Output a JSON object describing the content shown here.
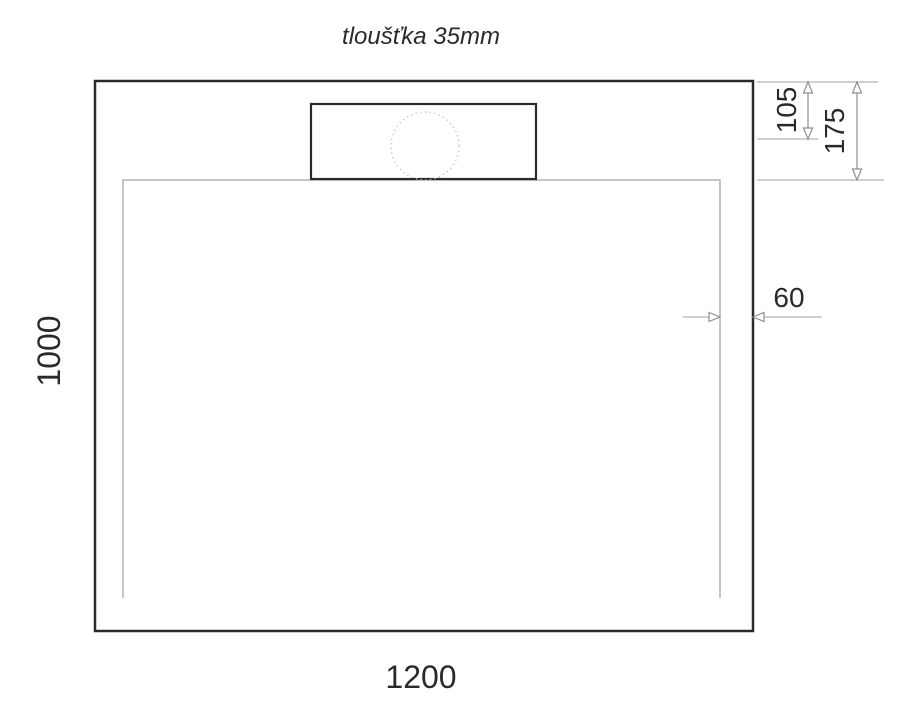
{
  "drawing": {
    "title": "tloušťka 35mm",
    "labels": {
      "bottom_width": "1200",
      "left_height": "1000",
      "right_rim_offset": "60",
      "drain_center_from_top": "105",
      "inner_edge_from_top": "175"
    },
    "colors": {
      "outline": "#2b2b2b",
      "thin_line": "#b4b4b4",
      "dotted_line": "#c2c2c2",
      "arrow": "#8f8f8f",
      "text": "#2a2a2a",
      "background": "#ffffff"
    }
  }
}
